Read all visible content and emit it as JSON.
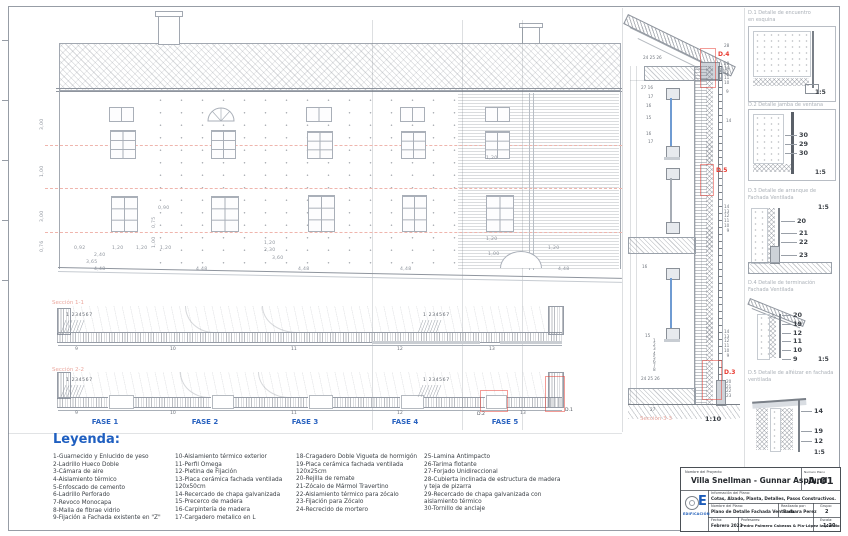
{
  "strips": {
    "s1_label": "Sección 1-1",
    "s2_label": "Sección 2-2",
    "callout": "1 234567",
    "s1_numbers": [
      "9",
      "10",
      "11",
      "12",
      "13"
    ],
    "s2_numbers": [
      "9",
      "10",
      "11",
      "12",
      "13"
    ],
    "d1": "D.1",
    "d2": "D.2"
  },
  "fases": [
    "FASE 1",
    "FASE 2",
    "FASE 3",
    "FASE 4",
    "FASE 5"
  ],
  "elevation": {
    "dims": [
      "0,92",
      "1,20",
      "1,20",
      "2,40",
      "3,65",
      "4,48",
      "4,48",
      "4,48",
      "4,48",
      "4,48",
      "0,90",
      "0,75",
      "1,00",
      "1,20",
      "1,20",
      "2,30",
      "3,60",
      "1,20",
      "1,20",
      "1,00",
      "3,00",
      "1,00",
      "3,00",
      "0,76",
      "1,20"
    ]
  },
  "vsection": {
    "d4": "D.4",
    "d5": "D.5",
    "d3": "D.3",
    "caption": "Sección 3-3",
    "scale": "1:10",
    "callouts": {
      "top": "24 25 26",
      "l1": "27 16",
      "l2": "17",
      "l3": "16",
      "l4": "15",
      "l5": "16",
      "l6": "17",
      "l7": "16",
      "l8": "15",
      "lstack": "1\n2\n3\n4\n5\n6\n7\n8",
      "lbot": "24 25 26",
      "lbot2": "27",
      "r28": "28",
      "rstack1": "20\n19\n12\n11\n10",
      "r9": "9",
      "r14": "14",
      "rstack2": "14\n13\n12\n11\n10\n9",
      "rstack3": "14\n13\n12\n11\n10\n9",
      "rstack4": "20\n21\n22\n23"
    }
  },
  "details": [
    {
      "id_title": "D.1  Detalle de encuentro",
      "title2": "en esquina",
      "scale": "1:5"
    },
    {
      "id_title": "D.2  Detalle jamba de ventana",
      "title2": "",
      "scale": "1:5",
      "c": [
        "30",
        "29",
        "30"
      ]
    },
    {
      "id_title": "D.3  Detalle de arranque de",
      "title2": "Fachada Ventilada",
      "scale": "1:5",
      "c": [
        "20",
        "21",
        "22",
        "23"
      ]
    },
    {
      "id_title": "D.4  Detalle de terminación",
      "title2": "Fachada Ventilada",
      "scale": "1:5",
      "c": [
        "20",
        "19",
        "12",
        "11",
        "10",
        "9"
      ]
    },
    {
      "id_title": "D.5  Detalle de alféizar en fachada",
      "title2": "ventilada",
      "scale": "1:5",
      "c": [
        "14",
        "19",
        "12"
      ]
    }
  ],
  "legend": {
    "title": "Leyenda:",
    "col1": [
      "1-Guarnecido y Enlucido de yeso",
      "2-Ladrillo Hueco Doble",
      "3-Cámara de aire",
      "4-Aislamiento térmico",
      "5-Enfoscado de cemento",
      "6-Ladrillo Perforado",
      "7-Revoco Monocapa",
      "8-Malla de fibrae vidrio",
      "9-Fijación a Fachada existente en \"Z\""
    ],
    "col2": [
      "10-Aislamiento térmico exterior",
      "11-Perfil Omega",
      "12-Pletina de Fijación",
      "13-Placa cerámica fachada ventilada 120x50cm",
      "14-Recercado de chapa galvanizada",
      "15-Precerco de madera",
      "16-Carpintería de madera",
      "17-Cargadero metalico en L"
    ],
    "col3": [
      "18-Cragadero Doble Vigueta de hormigón",
      "19-Placa cerámica fachada ventilada 120x25cm",
      "20-Rejilla de remate",
      "21-Zócalo de Mármol Travertino",
      "22-Aislamiento térmico para zócalo",
      "23-Fijación para Zócalo",
      "24-Recrecido de mortero"
    ],
    "col4": [
      "25-Lamina Antimpacto",
      "26-Tarima flotante",
      "27-Forjado Unidireccional",
      "28-Cubierta inclinada de estructura de madera y teja de pizarra",
      "29-Recercado de chapa galvanizada con aislamiento térmico",
      "30-Tornillo de anclaje"
    ]
  },
  "titleblock": {
    "project_label": "Nombre del Proyecto",
    "project_name": "Villa Snellman - Gunnar Asplund",
    "number_label": "Numero Plano",
    "number": "A.01",
    "info_label": "Información del Plano:",
    "info_value": "Cotas, Alzado, Planta, Detalles, Pasos Constructivos.",
    "plan_label": "Nombre del Plano:",
    "plan_value": "Plano de Detalle Fachada Ventilada",
    "author_label": "Realizado por:",
    "author_value": "Barbara Perez",
    "group_label": "Grupo:",
    "group_value": "2",
    "date_label": "Fecha:",
    "date_value": "Febrero 2023",
    "teachers_label": "Profesores:",
    "teachers_value": "Pedro Palmero Cabezas & Pla-López Izquierdo",
    "scale_label": "Escala:",
    "scale_value": "1:20",
    "org": "EDIFICACIÓN",
    "logo_e": "E"
  }
}
